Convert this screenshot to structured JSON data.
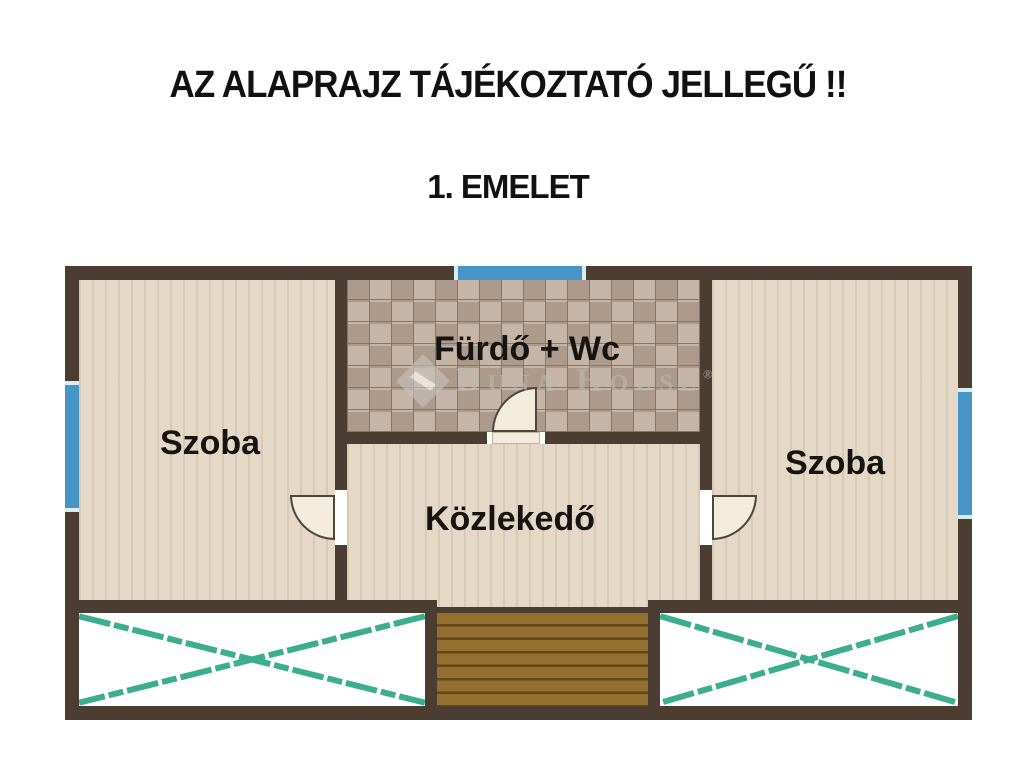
{
  "header": {
    "disclaimer": "AZ ALAPRAJZ TÁJÉKOZTATÓ JELLEGŰ !!",
    "floor_label": "1. EMELET"
  },
  "floorplan": {
    "room_left": "Szoba",
    "bathroom": "Fürdő + Wc",
    "hallway": "Közlekedő",
    "room_right": "Szoba"
  },
  "watermark": {
    "text": "Duna House",
    "registered_mark": "®"
  },
  "colors": {
    "wall": "#4c3d32",
    "floor_wood": "#e5d8c6",
    "tile_light": "#c6b5a6",
    "tile_dark": "#ae9a8a",
    "tile_grout": "#8a7462",
    "window_blue": "#4596c7",
    "stair_brown": "#93702f",
    "stair_groove": "#64481d",
    "hatch_teal": "#3bae8f",
    "door_cream": "#f3ecdc",
    "title_black": "#111111"
  }
}
